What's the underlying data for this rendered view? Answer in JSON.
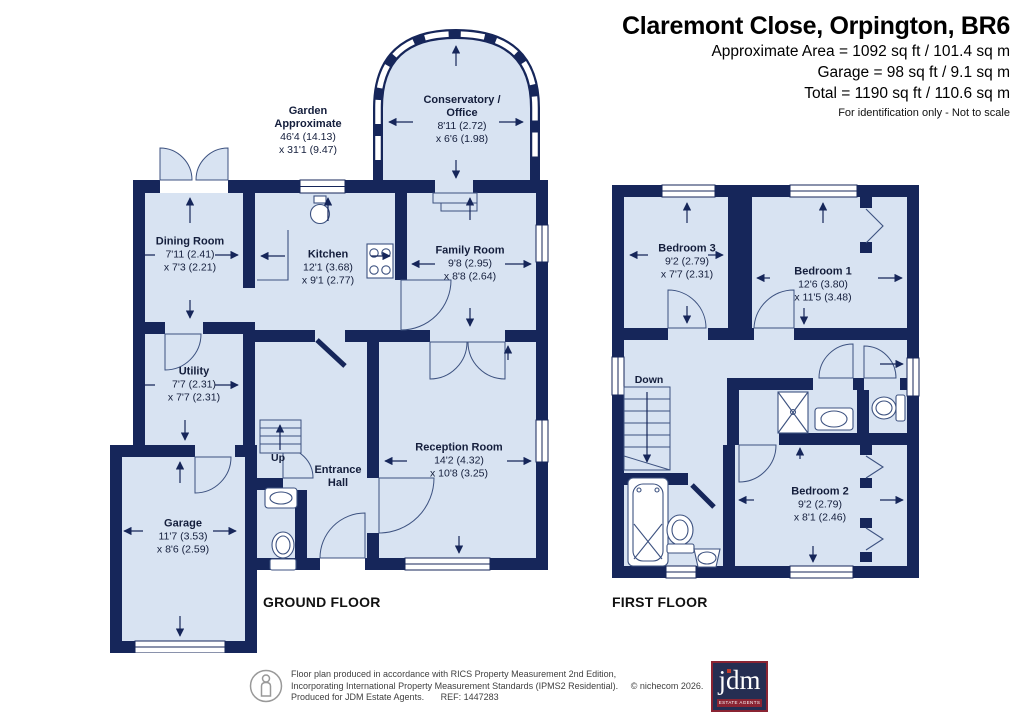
{
  "header": {
    "title": "Claremont Close, Orpington, BR6",
    "area_line": "Approximate Area = 1092 sq ft / 101.4 sq m",
    "garage_line": "Garage = 98 sq ft / 9.1 sq m",
    "total_line": "Total = 1190 sq ft / 110.6 sq m",
    "note": "For identification only - Not to scale"
  },
  "floors": {
    "ground": {
      "label": "GROUND FLOOR",
      "stairs_label": "Up",
      "rooms": {
        "garden": {
          "name1": "Garden",
          "name2": "Approximate",
          "dim1": "46'4 (14.13)",
          "dim2": "x 31'1 (9.47)"
        },
        "conservatory": {
          "name1": "Conservatory /",
          "name2": "Office",
          "dim1": "8'11 (2.72)",
          "dim2": "x 6'6 (1.98)"
        },
        "dining": {
          "name1": "Dining Room",
          "dim1": "7'11 (2.41)",
          "dim2": "x 7'3 (2.21)"
        },
        "kitchen": {
          "name1": "Kitchen",
          "dim1": "12'1 (3.68)",
          "dim2": "x 9'1 (2.77)"
        },
        "family": {
          "name1": "Family Room",
          "dim1": "9'8 (2.95)",
          "dim2": "x 8'8 (2.64)"
        },
        "utility": {
          "name1": "Utility",
          "dim1": "7'7 (2.31)",
          "dim2": "x 7'7 (2.31)"
        },
        "garage": {
          "name1": "Garage",
          "dim1": "11'7 (3.53)",
          "dim2": "x 8'6 (2.59)"
        },
        "hall": {
          "name1": "Entrance",
          "name2": "Hall"
        },
        "reception": {
          "name1": "Reception Room",
          "dim1": "14'2 (4.32)",
          "dim2": "x 10'8 (3.25)"
        }
      }
    },
    "first": {
      "label": "FIRST FLOOR",
      "stairs_label": "Down",
      "rooms": {
        "bedroom1": {
          "name1": "Bedroom 1",
          "dim1": "12'6 (3.80)",
          "dim2": "x 11'5 (3.48)"
        },
        "bedroom2": {
          "name1": "Bedroom 2",
          "dim1": "9'2 (2.79)",
          "dim2": "x 8'1 (2.46)"
        },
        "bedroom3": {
          "name1": "Bedroom 3",
          "dim1": "9'2 (2.79)",
          "dim2": "x 7'7 (2.31)"
        }
      }
    }
  },
  "footer": {
    "line1": "Floor plan produced in accordance with RICS Property Measurement 2nd Edition,",
    "line2": "Incorporating International Property Measurement Standards (IPMS2 Residential).",
    "copyright": "© nichecom 2026.",
    "line3": "Produced for JDM Estate Agents.",
    "ref": "REF: 1447283",
    "logo_text": "jdm",
    "logo_subtext": "ESTATE AGENTS"
  },
  "colors": {
    "wall_navy": "#16265a",
    "room_fill": "#d8e3f2",
    "logo_bg": "#252e52",
    "logo_maroon": "#8a2433",
    "logo_dot": "#c0392b"
  }
}
